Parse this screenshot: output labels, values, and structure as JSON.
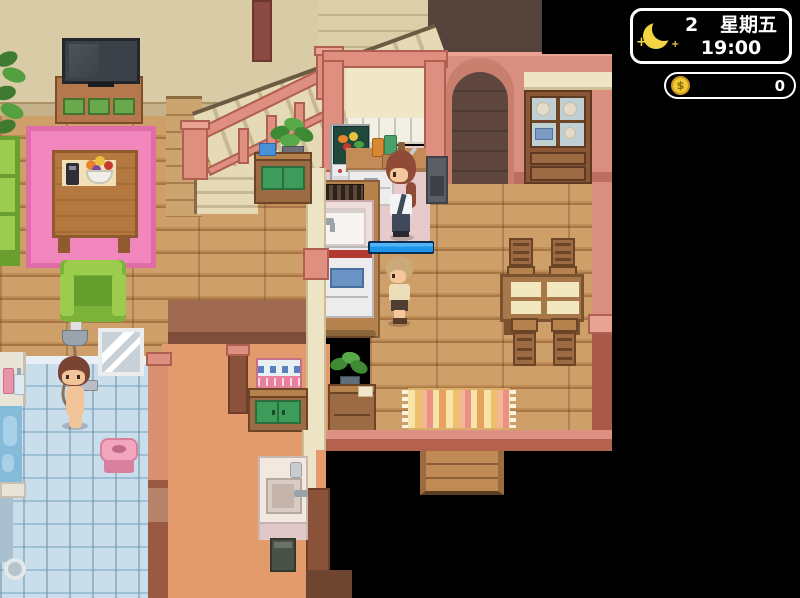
{
  "hud": {
    "clock": {
      "day": "2",
      "weekday": "星期五",
      "time": "19:00",
      "moon_icon": "crescent-moon",
      "sparkle": "+"
    },
    "money": {
      "amount": "0",
      "coin_icon": "gold-coin",
      "coin_symbol": "$"
    }
  },
  "scene": {
    "progress": {
      "pct": 95,
      "style": "width:95%"
    },
    "characters": [
      {
        "id": "mom-cooking",
        "location": "kitchen-counter"
      },
      {
        "id": "child-waiting",
        "location": "kitchen-floor"
      },
      {
        "id": "woman-showering",
        "location": "bathroom"
      }
    ],
    "objects": [
      "tv",
      "tv-stand",
      "potted-plant",
      "pink-rug",
      "coffee-table",
      "fruit-bowl",
      "remote-control",
      "green-couch",
      "green-armchair",
      "staircase",
      "understairs-cabinet",
      "fridge",
      "kitchen-counter",
      "sink-island",
      "stove",
      "wall-oven",
      "dining-table",
      "dining-chairs",
      "china-cabinet",
      "arch-doorway",
      "striped-rug",
      "side-table",
      "towel-cabinet",
      "washbasin",
      "trash-bin",
      "bathtub",
      "shower-head",
      "mirror",
      "bath-stool",
      "floor-drain",
      "descending-steps"
    ]
  },
  "palette": {
    "hud_border": "#ffffff",
    "hud_bg": "#000000",
    "moon": "#f5d442",
    "coin": "#f0c830",
    "wall_beige": "#d9cba6",
    "wall_salmon": "#de8f7f",
    "floor_wood": "#c99a63",
    "floor_tile": "#c9ddea",
    "floor_hall": "#e39a6d",
    "floor_kitchen": "#e7cbcb",
    "rug_pink": "#f287be",
    "sofa_green": "#7ab338",
    "progress_blue": "#1f96e8"
  }
}
